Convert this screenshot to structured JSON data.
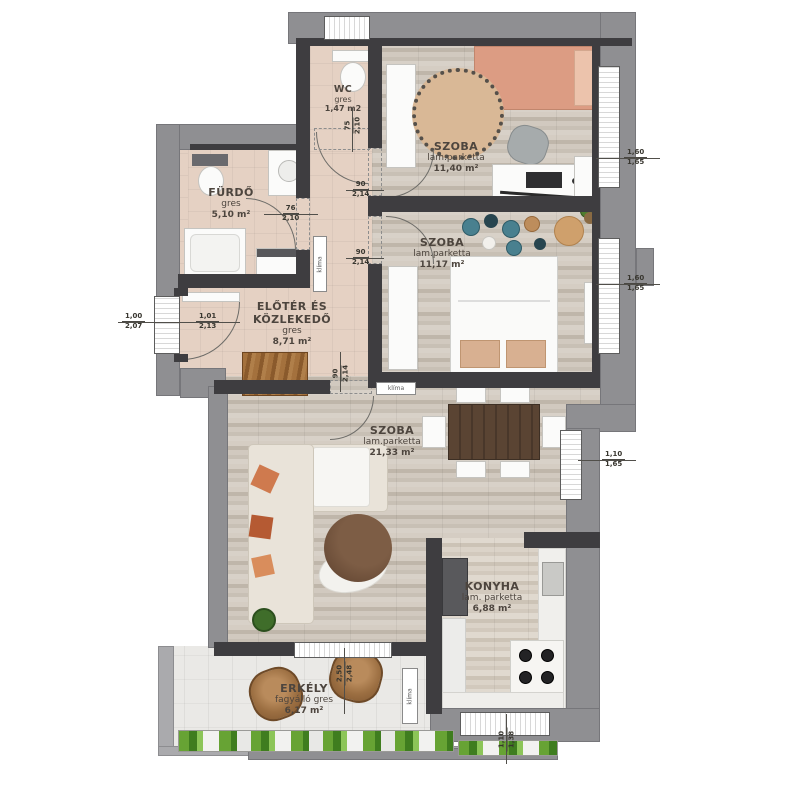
{
  "rooms": {
    "wc": {
      "name": "WC",
      "material": "gres",
      "area": "1,47 m2"
    },
    "szoba1": {
      "name": "SZOBA",
      "material": "lam.parketta",
      "area": "11,40 m²"
    },
    "furdo": {
      "name": "FÜRDŐ",
      "material": "gres",
      "area": "5,10 m²"
    },
    "eloter": {
      "name1": "ELŐTÉR ÉS",
      "name2": "KÖZLEKEDŐ",
      "material": "gres",
      "area": "8,71 m²"
    },
    "szoba2": {
      "name": "SZOBA",
      "material": "lam.parketta",
      "area": "11,17 m²"
    },
    "szoba3": {
      "name": "SZOBA",
      "material": "lam.parketta",
      "area": "21,33 m²"
    },
    "konyha": {
      "name": "KONYHA",
      "material": "lam. parketta",
      "area": "6,88 m²"
    },
    "erkely": {
      "name": "ERKÉLY",
      "material": "fagyálló gres",
      "area": "6,17 m²"
    }
  },
  "equipment": {
    "klima": "klíma"
  },
  "dimensions": {
    "window_bed1": {
      "w": "1,60",
      "h": "1,65"
    },
    "window_bed2": {
      "w": "1,60",
      "h": "1,65"
    },
    "window_living": {
      "w": "1,10",
      "h": "1,65"
    },
    "window_kitchen": {
      "w": "1,10",
      "h": "1,38"
    },
    "entry_outer": {
      "w": "1,00",
      "h": "2,07"
    },
    "entry_inner": {
      "w": "1,01",
      "h": "2,13"
    },
    "door_bath": {
      "w": "76",
      "h": "2,10"
    },
    "door_wc": {
      "w": "75",
      "h": "2,10"
    },
    "door_bed1": {
      "w": "90",
      "h": "2,14"
    },
    "door_bed2": {
      "w": "90",
      "h": "2,14"
    },
    "door_living": {
      "w": "90",
      "h": "2,14"
    },
    "door_balcony": {
      "w": "2,50",
      "h": "2,48"
    }
  },
  "colors": {
    "wall_outer": "#8f8f92",
    "wall_inner": "#3e3d40",
    "floor_tile": "#e5d1c3",
    "floor_wood": "#cfc7bc",
    "bed_coral": "#dc9c83",
    "pillow_orange": "#cf7a4e",
    "table_wood": "#5a4433",
    "plant_green": "#4e7d2e",
    "decor_teal": "#49808f"
  }
}
